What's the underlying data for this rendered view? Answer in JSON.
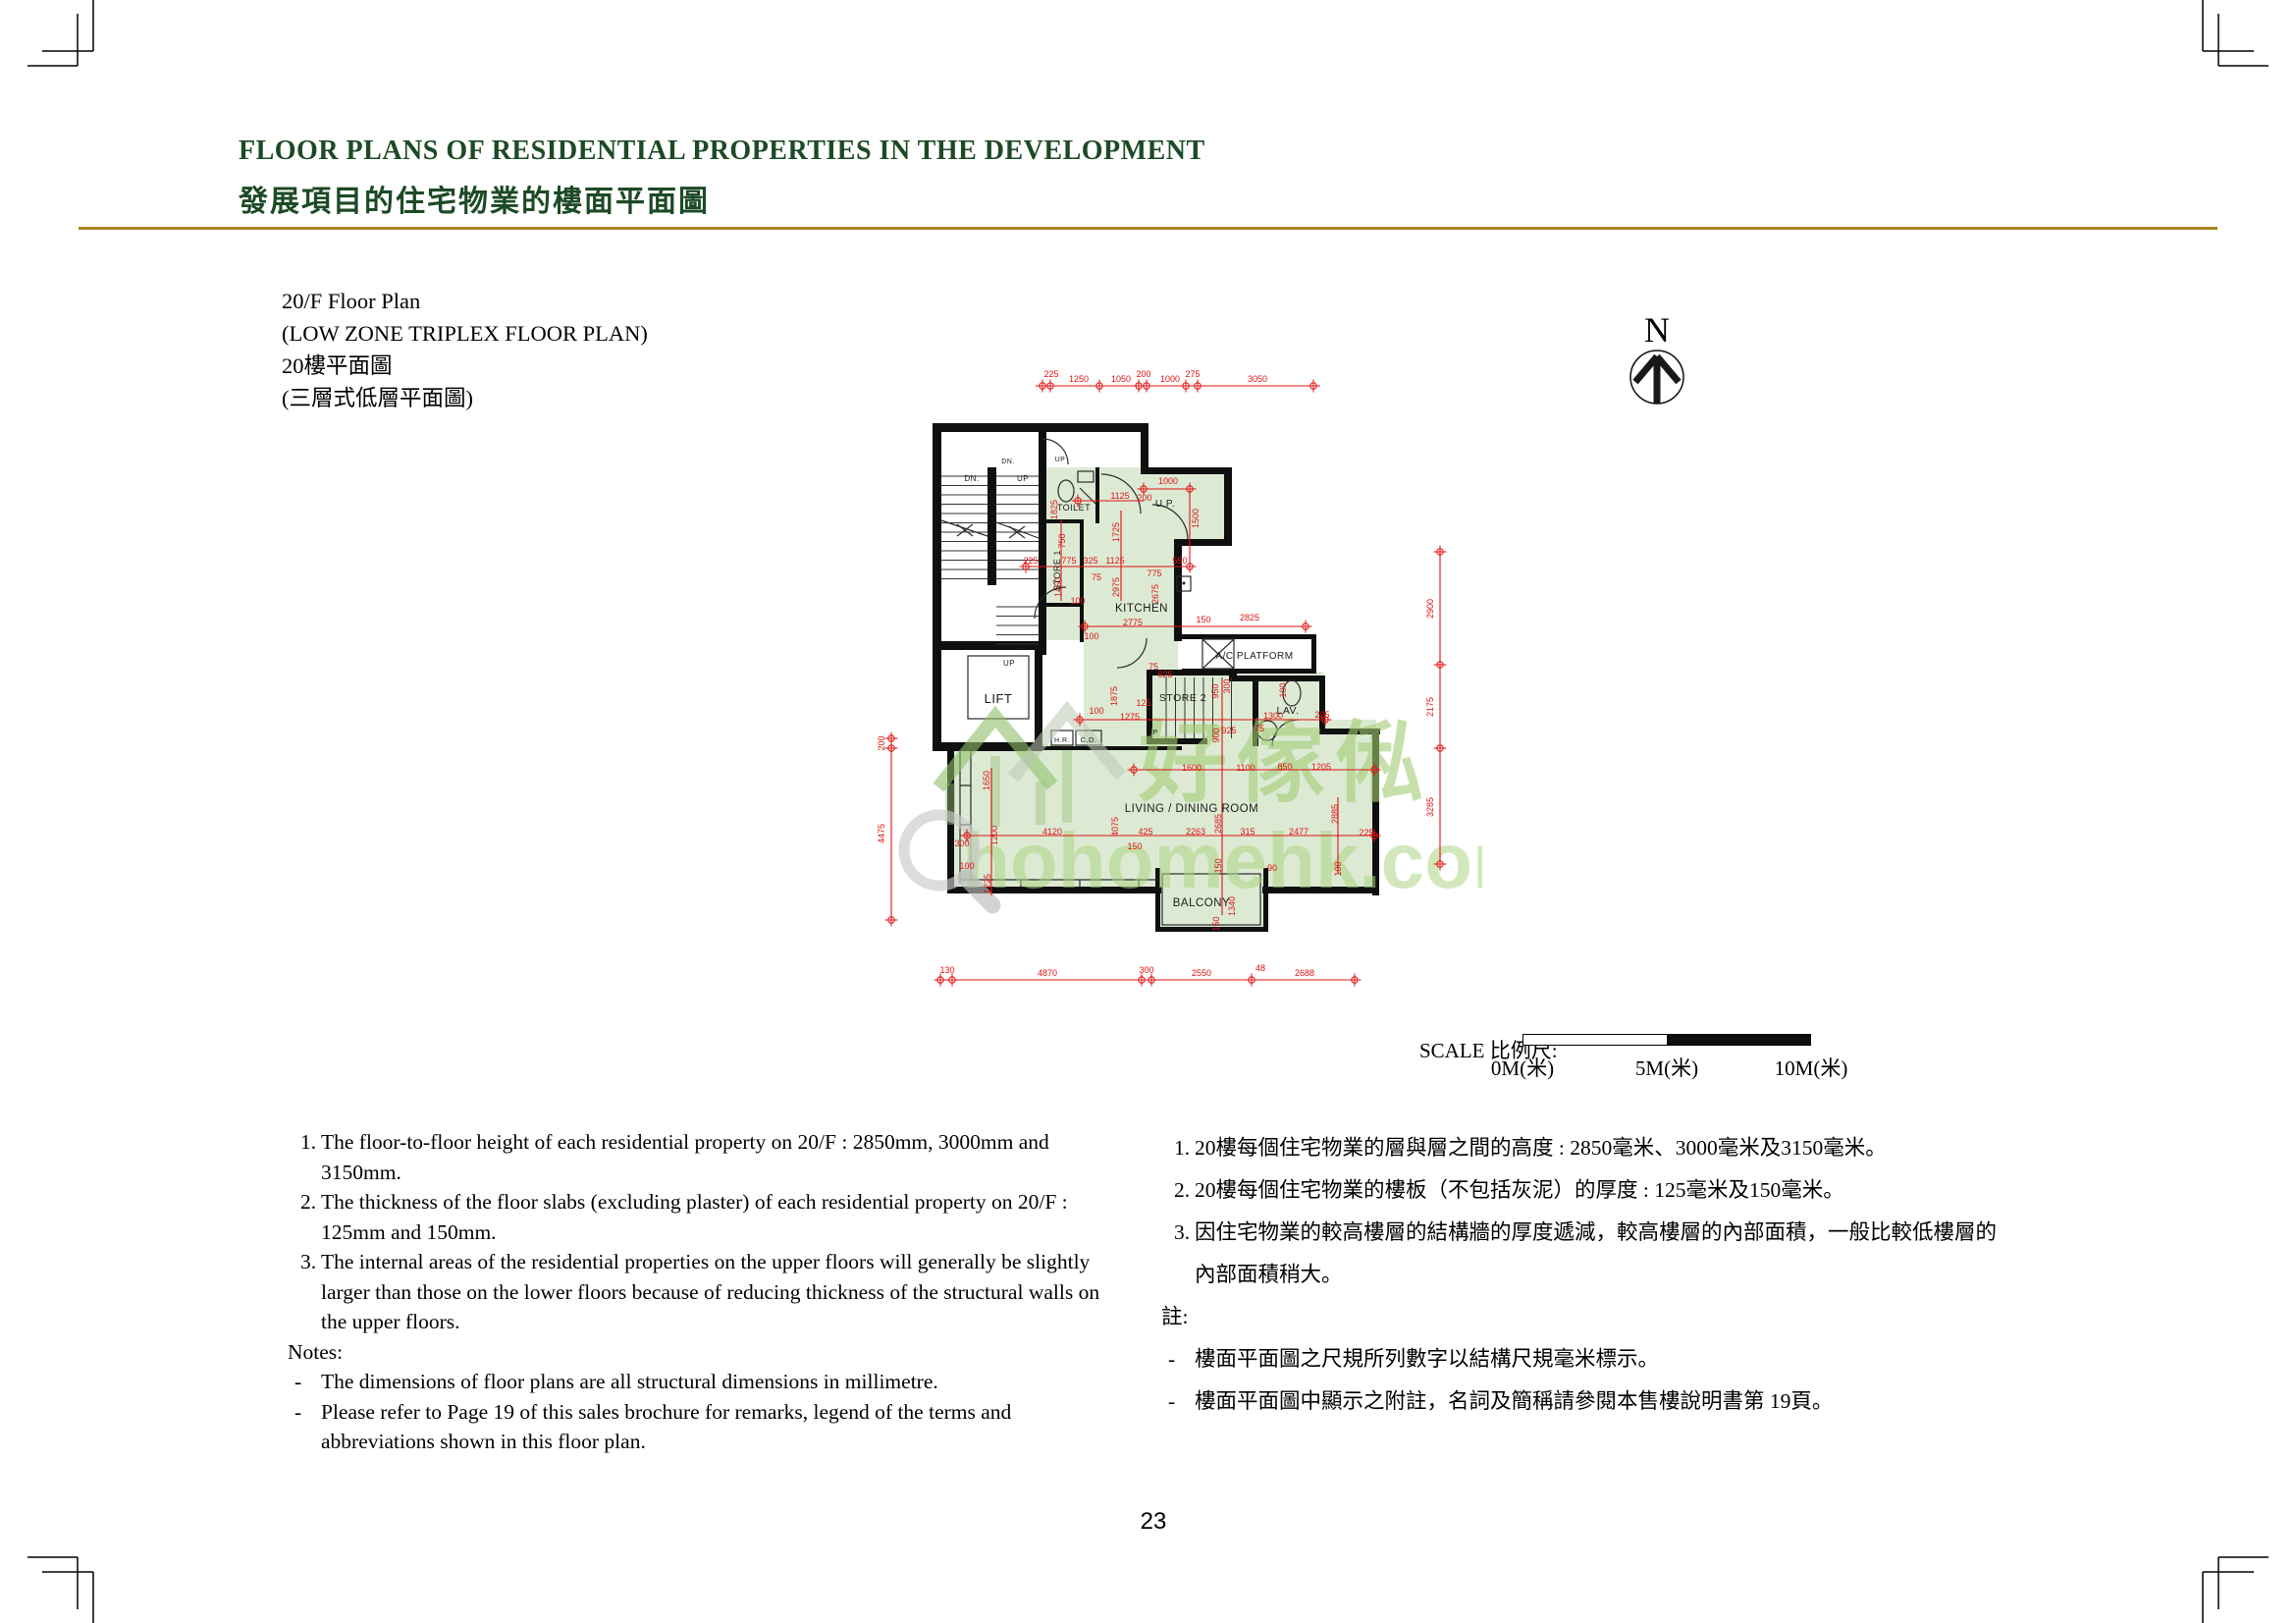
{
  "header": {
    "title_en": "FLOOR PLANS OF RESIDENTIAL PROPERTIES IN THE DEVELOPMENT",
    "title_zh": "發展項目的住宅物業的樓面平面圖"
  },
  "plan_title": {
    "line1": "20/F Floor Plan",
    "line2": "(LOW ZONE TRIPLEX FLOOR PLAN)",
    "line3": "20樓平面圖",
    "line4": "(三層式低層平面圖)"
  },
  "north": {
    "label": "N"
  },
  "watermark": {
    "zh": "好傢俬",
    "domain": "hohomehk.com"
  },
  "scale_bar": {
    "label": "SCALE 比例尺:",
    "tick0": "0M(米)",
    "tick5": "5M(米)",
    "tick10": "10M(米)"
  },
  "page_number": "23",
  "colors": {
    "heading_green": "#1d4a26",
    "rule_gold": "#a8881f",
    "dimension_red": "#e01212",
    "room_fill_green": "#dcead4",
    "watermark_green": "#a5cf78"
  },
  "notes_en": {
    "nums": [
      "1.",
      "2.",
      "3."
    ],
    "items": [
      "The floor-to-floor height of each residential property on 20/F : 2850mm, 3000mm and 3150mm.",
      "The thickness of the floor slabs (excluding plaster) of each residential property on 20/F : 125mm and 150mm.",
      "The internal areas of the residential properties on the upper floors will generally be slightly larger than those on the lower floors because of reducing thickness of the structural walls on the upper floors."
    ],
    "label": "Notes:",
    "dash": "-",
    "dashes": [
      "The dimensions of floor plans are all structural dimensions in millimetre.",
      "Please refer to Page 19 of this sales brochure for remarks, legend of the terms and abbreviations shown in this floor plan."
    ]
  },
  "notes_zh": {
    "nums": [
      "1.",
      "2.",
      "3."
    ],
    "items": [
      "20樓每個住宅物業的層與層之間的高度 : 2850毫米、3000毫米及3150毫米。",
      "20樓每個住宅物業的樓板（不包括灰泥）的厚度 : 125毫米及150毫米。",
      "因住宅物業的較高樓層的結構牆的厚度遞減，較高樓層的內部面積，一般比較低樓層的內部面積稍大。"
    ],
    "label": "註:",
    "dash": "-",
    "dashes": [
      "樓面平面圖之尺規所列數字以結構尺規毫米標示。",
      "樓面平面圖中顯示之附註，名詞及簡稱請參閱本售樓說明書第 19頁。"
    ]
  },
  "floor_plan": {
    "labels": [
      [
        "LIFT",
        1017,
        716,
        13
      ],
      [
        "TOILET",
        1094,
        520,
        9
      ],
      [
        "STORE 1",
        1080,
        581,
        9,
        1
      ],
      [
        "KITCHEN",
        1163,
        623,
        11.5
      ],
      [
        "U.P.",
        1187,
        516,
        10
      ],
      [
        "A/C PLATFORM",
        1278,
        671,
        10
      ],
      [
        "STORE 2",
        1205,
        714,
        10.5
      ],
      [
        "LAV.",
        1312,
        727,
        10.5
      ],
      [
        "H.R.",
        1082,
        756,
        7
      ],
      [
        "C.D.",
        1109,
        756,
        7.5
      ],
      [
        "LIVING / DINING ROOM",
        1214,
        827,
        11.5
      ],
      [
        "BALCONY",
        1224,
        923,
        11.5
      ],
      [
        "DN.",
        990,
        490,
        8
      ],
      [
        "UP",
        1042,
        490,
        8
      ],
      [
        "DN.",
        1027,
        472,
        7
      ],
      [
        "UP",
        1080,
        470,
        7
      ],
      [
        "DN.",
        1044,
        661,
        8
      ],
      [
        "UP",
        1028,
        678,
        8
      ],
      [
        "UP",
        1174,
        748,
        7.5
      ]
    ],
    "dims": [
      [
        "225",
        1071,
        384
      ],
      [
        "1250",
        1099,
        389
      ],
      [
        "1050",
        1142,
        389
      ],
      [
        "200",
        1165,
        384
      ],
      [
        "1000",
        1192,
        389
      ],
      [
        "275",
        1215,
        384
      ],
      [
        "3050",
        1281,
        389
      ],
      [
        "130",
        965,
        991
      ],
      [
        "4870",
        1067,
        994
      ],
      [
        "300",
        1168,
        991
      ],
      [
        "2550",
        1224,
        994
      ],
      [
        "48",
        1284,
        989
      ],
      [
        "2688",
        1329,
        994
      ],
      [
        "200",
        901,
        757,
        1
      ],
      [
        "4475",
        901,
        849,
        1
      ],
      [
        "2900",
        1460,
        620,
        1
      ],
      [
        "2175",
        1460,
        720,
        1
      ],
      [
        "3285",
        1460,
        822,
        1
      ],
      [
        "1000",
        1190,
        493
      ],
      [
        "1125",
        1141,
        508
      ],
      [
        "200",
        1166,
        510
      ],
      [
        "1500",
        1221,
        528,
        1
      ],
      [
        "1725",
        1140,
        542,
        1
      ],
      [
        "750",
        1085,
        551,
        1
      ],
      [
        "1825",
        1077,
        519,
        1
      ],
      [
        "225",
        1050,
        574
      ],
      [
        "775",
        1089,
        574
      ],
      [
        "325",
        1111,
        574
      ],
      [
        "1125",
        1136,
        574
      ],
      [
        "550",
        1202,
        574
      ],
      [
        "75",
        1117,
        591
      ],
      [
        "1450",
        1081,
        598,
        1
      ],
      [
        "100",
        1098,
        615
      ],
      [
        "2975",
        1140,
        598,
        1
      ],
      [
        "2675",
        1180,
        605,
        1
      ],
      [
        "775",
        1176,
        587
      ],
      [
        "2775",
        1154,
        637
      ],
      [
        "150",
        1226,
        634
      ],
      [
        "2825",
        1273,
        632
      ],
      [
        "100",
        1112,
        651
      ],
      [
        "625",
        1187,
        690
      ],
      [
        "75",
        1175,
        682
      ],
      [
        "125",
        1165,
        719
      ],
      [
        "1275",
        1151,
        733
      ],
      [
        "1875",
        1138,
        709,
        1
      ],
      [
        "100",
        1117,
        727
      ],
      [
        "950",
        1241,
        704,
        1
      ],
      [
        "300",
        1253,
        699,
        1
      ],
      [
        "900",
        1242,
        749,
        1
      ],
      [
        "925",
        1252,
        747
      ],
      [
        "1300",
        1297,
        732
      ],
      [
        "225",
        1347,
        731
      ],
      [
        "75",
        1283,
        745
      ],
      [
        "100",
        1310,
        703,
        1
      ],
      [
        "1600",
        1214,
        785
      ],
      [
        "1100",
        1269,
        785
      ],
      [
        "850",
        1309,
        784
      ],
      [
        "1205",
        1346,
        784
      ],
      [
        "1650",
        1008,
        795,
        1
      ],
      [
        "1200",
        1016,
        851,
        1
      ],
      [
        "300",
        980,
        862
      ],
      [
        "100",
        985,
        885
      ],
      [
        "1225",
        1009,
        900,
        1
      ],
      [
        "4120",
        1072,
        850
      ],
      [
        "4075",
        1139,
        842,
        1
      ],
      [
        "150",
        1156,
        865
      ],
      [
        "425",
        1167,
        850
      ],
      [
        "2263",
        1218,
        850
      ],
      [
        "2685",
        1244,
        839,
        1
      ],
      [
        "315",
        1271,
        850
      ],
      [
        "2477",
        1323,
        850
      ],
      [
        "225",
        1392,
        851
      ],
      [
        "2885",
        1363,
        829,
        1
      ],
      [
        "100",
        1366,
        885,
        1
      ],
      [
        "150",
        1244,
        882,
        1
      ],
      [
        "90",
        1296,
        887
      ],
      [
        "1340",
        1258,
        923,
        1
      ],
      [
        "150",
        1242,
        941,
        1
      ]
    ],
    "lines": [
      [
        1055,
        393,
        1345,
        393
      ],
      [
        958,
        998,
        1380,
        998
      ],
      [
        908,
        750,
        908,
        940
      ],
      [
        1467,
        560,
        1467,
        882
      ],
      [
        1165,
        498,
        1212,
        498
      ],
      [
        1098,
        510,
        1165,
        510
      ],
      [
        1040,
        577,
        1215,
        577
      ],
      [
        1105,
        638,
        1330,
        638
      ],
      [
        1100,
        733,
        1350,
        733
      ],
      [
        1155,
        784,
        1400,
        784
      ],
      [
        985,
        851,
        1400,
        851
      ],
      [
        1212,
        498,
        1212,
        577
      ],
      [
        1142,
        520,
        1142,
        612
      ],
      [
        1081,
        530,
        1081,
        612
      ],
      [
        1010,
        782,
        1010,
        912
      ],
      [
        1245,
        692,
        1245,
        932
      ],
      [
        1363,
        812,
        1363,
        890
      ]
    ],
    "ticks": [
      [
        1062,
        393
      ],
      [
        1070,
        393
      ],
      [
        1120,
        393
      ],
      [
        1160,
        393
      ],
      [
        1168,
        393
      ],
      [
        1208,
        393
      ],
      [
        1220,
        393
      ],
      [
        1338,
        393
      ],
      [
        958,
        998
      ],
      [
        970,
        998
      ],
      [
        1163,
        998
      ],
      [
        1173,
        998
      ],
      [
        1275,
        998
      ],
      [
        1380,
        998
      ],
      [
        908,
        752
      ],
      [
        908,
        762
      ],
      [
        908,
        937
      ],
      [
        1467,
        562
      ],
      [
        1467,
        677
      ],
      [
        1467,
        762
      ],
      [
        1467,
        880
      ],
      [
        1165,
        498
      ],
      [
        1212,
        498
      ],
      [
        1098,
        510
      ],
      [
        1045,
        577
      ],
      [
        1212,
        577
      ],
      [
        1105,
        638
      ],
      [
        1330,
        638
      ],
      [
        1100,
        733
      ],
      [
        1350,
        733
      ],
      [
        1155,
        784
      ],
      [
        1400,
        784
      ],
      [
        985,
        851
      ],
      [
        1400,
        851
      ]
    ]
  }
}
